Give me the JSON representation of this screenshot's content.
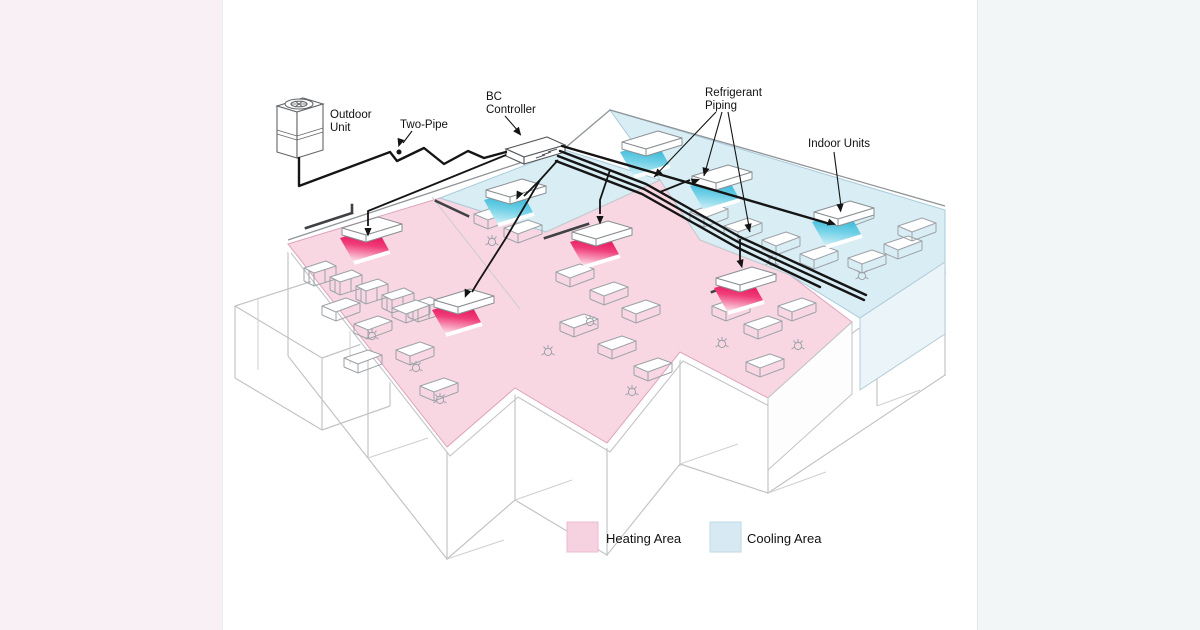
{
  "page": {
    "background": "#ffffff",
    "left_band_color": "#f8f0f4",
    "right_band_color": "#f3f6f7"
  },
  "diagram": {
    "title_implicit": "Two-pipe VRF system with simultaneous heating and cooling zones",
    "labels": {
      "outdoor_unit": {
        "line1": "Outdoor",
        "line2": "Unit"
      },
      "two_pipe": "Two-Pipe",
      "bc_controller": {
        "line1": "BC",
        "line2": "Controller"
      },
      "refrigerant_piping": {
        "line1": "Refrigerant",
        "line2": "Piping"
      },
      "indoor_units": "Indoor Units"
    },
    "legend": {
      "heating": {
        "label": "Heating Area",
        "color": "#f6d2e1"
      },
      "cooling": {
        "label": "Cooling Area",
        "color": "#d7eaf3"
      }
    },
    "areas": {
      "heating_color": "#f8d7e3",
      "cooling_color": "#d9edf5"
    },
    "units": {
      "heating_count": 4,
      "cooling_count": 4,
      "heating_discharge_color": "#e2004f",
      "cooling_discharge_color": "#22aed3",
      "heating_discharge_fade": "#ffffff",
      "cooling_discharge_fade": "#e2f5fa"
    },
    "components": [
      "Outdoor Unit",
      "Two-Pipe",
      "BC Controller",
      "Refrigerant Piping",
      "Indoor Units"
    ]
  }
}
